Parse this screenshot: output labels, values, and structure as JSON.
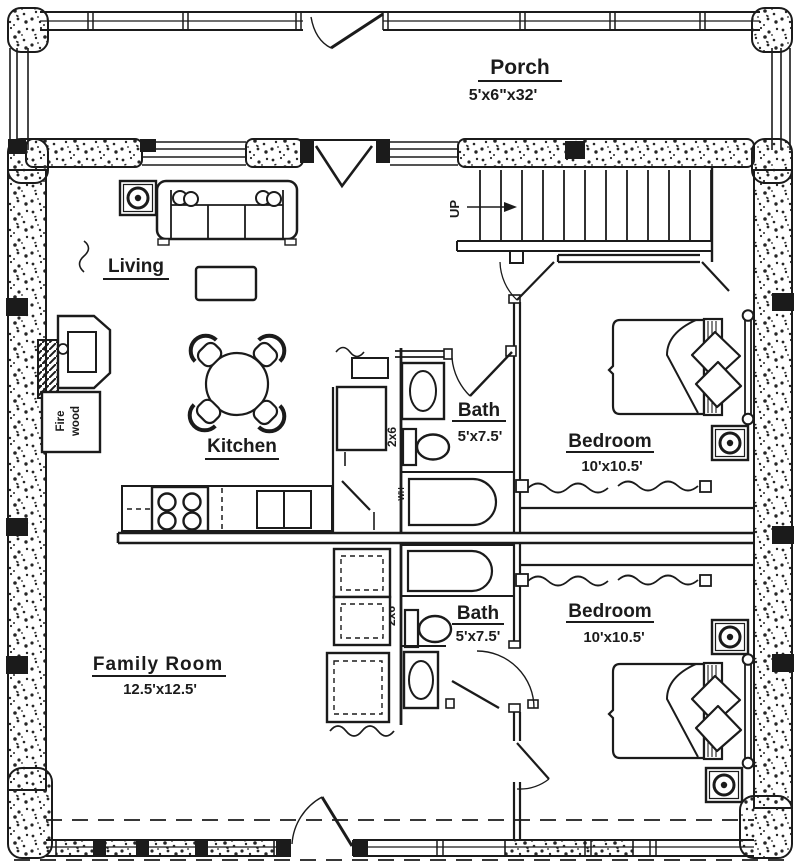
{
  "rooms": {
    "porch": {
      "label": "Porch",
      "dims": "5'x6\"x32'"
    },
    "living": {
      "label": "Living"
    },
    "kitchen": {
      "label": "Kitchen"
    },
    "bath1": {
      "label": "Bath",
      "dims": "5'x7.5'"
    },
    "bath2": {
      "label": "Bath",
      "dims": "5'x7.5'"
    },
    "bedroom1": {
      "label": "Bedroom",
      "dims": "10'x10.5'"
    },
    "bedroom2": {
      "label": "Bedroom",
      "dims": "10'x10.5'"
    },
    "family": {
      "label": "Family  Room",
      "dims": "12.5'x12.5'"
    }
  },
  "annotations": {
    "up": "UP",
    "stud_wall_top": "2x6",
    "stud_wall_bottom": "2x6",
    "water_heater": "WH",
    "firewood_line1": "Fire",
    "firewood_line2": "wood"
  },
  "colors": {
    "ink": "#1b1b1b",
    "paper": "#ffffff"
  }
}
